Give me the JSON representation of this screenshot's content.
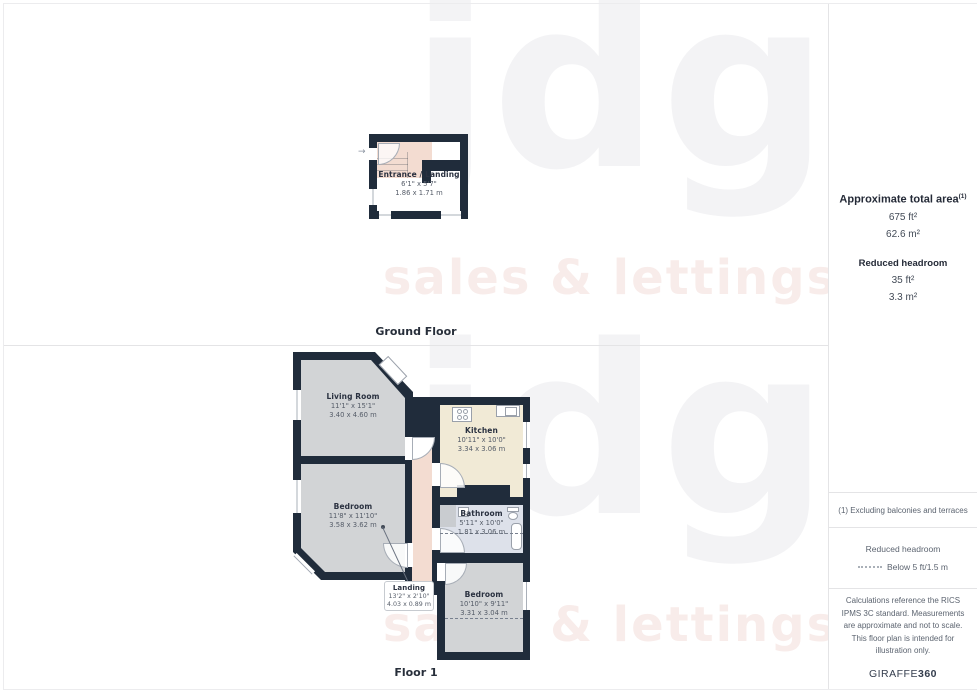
{
  "watermark": {
    "text": "jdg",
    "subtext": "sales & lettings"
  },
  "icons": {
    "entry_arrow": "→"
  },
  "floors": [
    {
      "label": "Ground Floor",
      "rooms": [
        {
          "name": "Entrance / Landing",
          "imperial": "6'1\" x 5'7\"",
          "metric": "1.86 x 1.71 m"
        }
      ]
    },
    {
      "label": "Floor 1",
      "rooms": [
        {
          "name": "Living Room",
          "imperial": "11'1\" x 15'1\"",
          "metric": "3.40 x 4.60 m"
        },
        {
          "name": "Kitchen",
          "imperial": "10'11\" x 10'0\"",
          "metric": "3.34 x 3.06 m"
        },
        {
          "name": "Bedroom",
          "imperial": "11'8\" x 11'10\"",
          "metric": "3.58 x 3.62 m"
        },
        {
          "name": "Bathroom",
          "imperial": "5'11\" x 10'0\"",
          "metric": "1.81 x 3.06 m"
        },
        {
          "name": "Landing",
          "imperial": "13'2\" x 2'10\"",
          "metric": "4.03 x 0.89 m"
        },
        {
          "name": "Bedroom",
          "imperial": "10'10\" x 9'11\"",
          "metric": "3.31 x 3.04 m"
        }
      ]
    }
  ],
  "sidebar": {
    "total_area_label": "Approximate total area",
    "total_area_superscript": "(1)",
    "total_area_ft": "675 ft²",
    "total_area_m": "62.6 m²",
    "reduced_headroom_label": "Reduced headroom",
    "reduced_headroom_ft": "35 ft²",
    "reduced_headroom_m": "3.3 m²",
    "footnote": "(1) Excluding balconies and terraces",
    "legend_title": "Reduced headroom",
    "legend_value": "Below 5 ft/1.5 m",
    "disclaimer": "Calculations reference the RICS IPMS 3C standard. Measurements are approximate and not to scale. This floor plan is intended for illustration only.",
    "brand": "GIRAFFE",
    "brand_suffix": "360"
  },
  "colors": {
    "wall": "#202c3b",
    "room_gray": "#d2d4d6",
    "kitchen_cream": "#f1ead6",
    "bathroom_blue": "#dde1ea",
    "landing_pink": "#f3dcd1"
  }
}
